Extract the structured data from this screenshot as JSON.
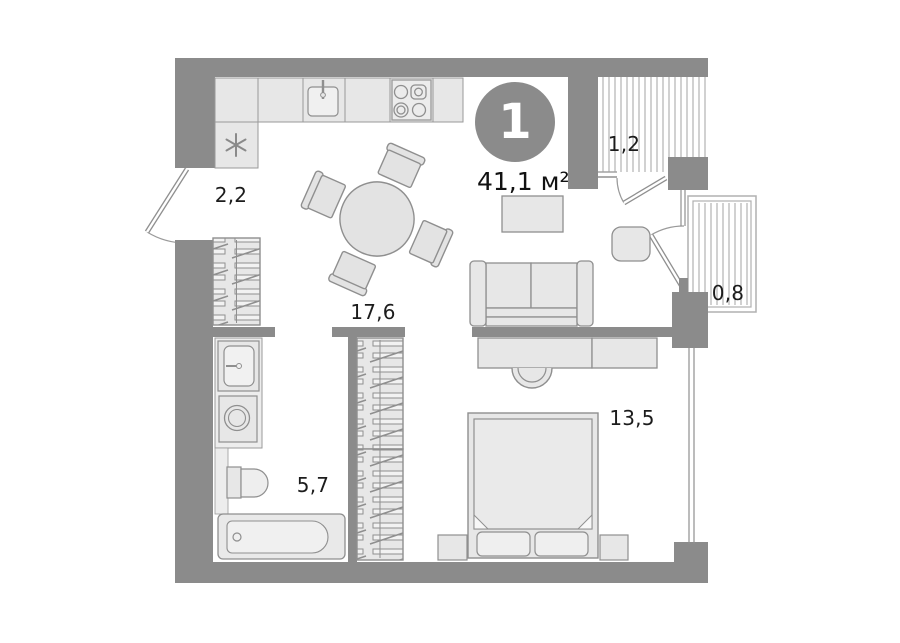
{
  "plan": {
    "unit_badge": "1",
    "area": "41,1 м²",
    "rooms": {
      "hallway": "2,2",
      "balcony_top": "1,2",
      "balcony_right": "0,8",
      "living": "17,6",
      "bathroom": "5,7",
      "bedroom": "13,5"
    },
    "colors": {
      "wall": "#8b8b8b",
      "furniture_fill": "#e7e7e7",
      "outline": "#8f8f8f",
      "hatch": "#a3a3a3",
      "text": "#1c1c1c",
      "badge_bg": "#8b8b8b",
      "badge_text": "#ffffff"
    }
  }
}
